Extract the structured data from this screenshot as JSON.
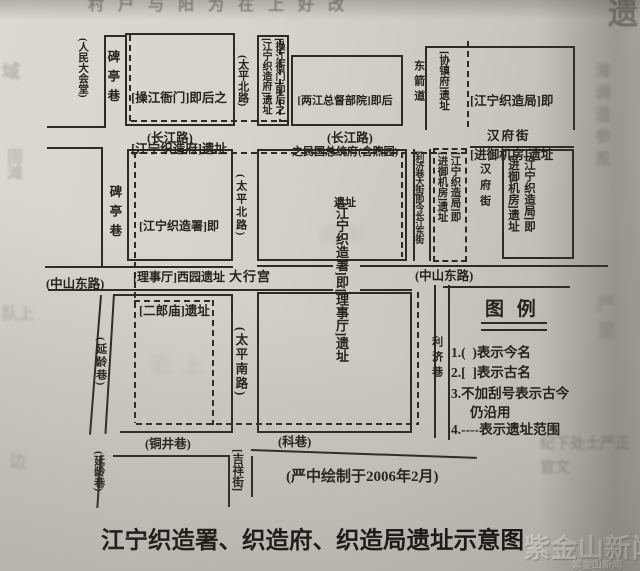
{
  "colors": {
    "ink": "#2e2a24",
    "paper": "#d7d3cc",
    "text": "#27221b"
  },
  "labels": {
    "renmin_dahuitang": "(人民大会堂)",
    "beitingxiang_n": "碑亭巷",
    "beitingxiang_s": "碑亭巷",
    "siteA_l1": "[操江衙门]即后之",
    "siteA_l2": "[江宁织造府]遗址",
    "taiping_north_rd_n": "(太平北路)",
    "taiping_north_rd_s": "(太平北路)",
    "siteB_c1": "[操江衙门]即后之",
    "siteB_c2": "[江宁织造府]遗址",
    "siteC_l1": "[两江总督部院]即后",
    "siteC_l2": "之民国总统府(含煦园)",
    "siteC_l3": "遗址",
    "dongjiandao": "东箭道",
    "xiezhenfu": "[协镇府]遗址",
    "siteD_l1": "[江宁织造局]即",
    "siteD_l2": "[进御机房]遗址",
    "hanfujie_top": "汉府街",
    "hanfujie_v": "汉府街",
    "changjiang_rd_w": "(长江路)",
    "changjiang_rd_e": "(长江路)",
    "siteE_l1": "[江宁织造署]即",
    "siteE_l2": "[理事厅]西园遗址",
    "lijixiang_dajie": "[利济巷大街]即今长江东街",
    "siteF_c1": "[江宁织造局]即",
    "siteF_c2": "[进御机房]遗址",
    "siteG_c1": "[江宁织造局]即",
    "siteG_c2": "[进御机房]遗址",
    "daxinggong": "大行宫",
    "zhongshan_east_rd_w": "(中山东路)",
    "zhongshan_east_rd_e": "(中山东路)",
    "siteH": "[江宁织造署]即[理事厅]遗址",
    "erlangmiao": "[二郎庙]遗址",
    "yanlingxiang_n": "(延龄巷)",
    "yanlingxiang_s": "(延龄巷)",
    "taiping_south_rd": "(太平南路)",
    "lijixiang": "利济巷",
    "tongjingxiang": "(铜井巷)",
    "kexiang": "(科巷)",
    "jixiangjie": "[吉祥街]",
    "attribution": "(严中绘制于2006年2月)",
    "title": "江宁织造署、织造府、织造局遗址示意图"
  },
  "legend": {
    "title": "图 例",
    "lines": [
      "1.(  )表示今名",
      "2.[  ]表示古名",
      "3.不加刮号表示古今",
      "仍沿用",
      "4.----表示遗址范围"
    ]
  },
  "watermark": {
    "main": "紫金山新闻",
    "sub": "紫金山新闻"
  },
  "decor": {
    "ghosts": [
      "村户与阳为在上好改",
      "遗",
      "域",
      "固滩",
      "队上",
      "海调温参差",
      "严里",
      "纪下处士严正官文",
      "边",
      "近上",
      "的好"
    ]
  }
}
